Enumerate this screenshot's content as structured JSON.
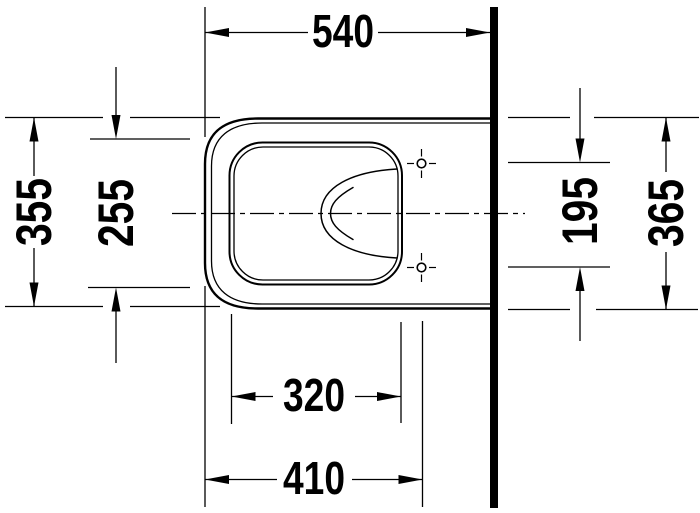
{
  "colors": {
    "ink": "#000000",
    "paper": "#ffffff"
  },
  "dims": {
    "top": "540",
    "left_outer": "355",
    "left_inner": "255",
    "right_holes": "195",
    "right_outer": "365",
    "bottom_bowl": "320",
    "bottom_holes": "410"
  }
}
